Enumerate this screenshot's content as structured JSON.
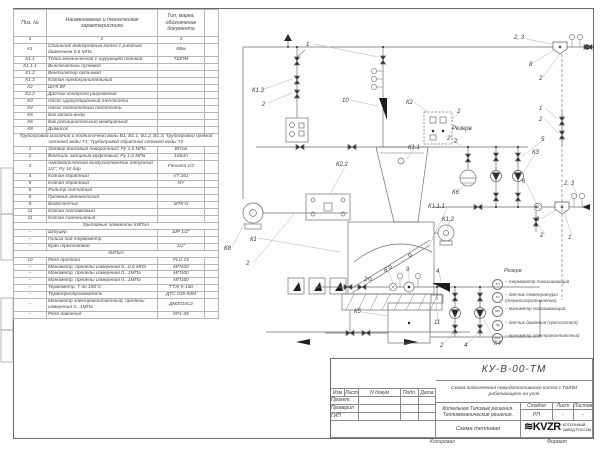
{
  "sheet": {
    "doc_code": "КУ-В-00-ТМ",
    "doc_title": "Схема подключения твердотопливного котла с ТШПМ работающего на угле",
    "object_line1": "Котельная.Типовые решения.",
    "object_line2": "Тепломеханические решения.",
    "stage_label": "Стадия",
    "stage_value": "РП",
    "sheet_label": "Лист",
    "sheet_value": "-",
    "sheets_label": "Листов",
    "sheets_value": "-",
    "drawing_name": "Схема тепловая",
    "logo_text": "KVZR",
    "logo_glyph": "≋",
    "company_line1": "КОТЕЛЬНЫЙ",
    "company_line2": "ЗАВОД РОССИИ",
    "footer_left": "Копировал",
    "footer_right": "Формат",
    "sign_cols": [
      "Изм",
      "Лист",
      "N докум",
      "Подп.",
      "Дата"
    ],
    "sign_rows": [
      "Проект.",
      "Проверил",
      "ГИП"
    ]
  },
  "spec_table": {
    "headers": [
      "Поз. №",
      "Наименование и техническая характеристика",
      "Тип, марка, обозначение документа"
    ],
    "col_numbers": [
      "1",
      "2",
      "3"
    ],
    "rows": [
      {
        "pos": "К1",
        "name": "Стальной водогрейный котел с рабочим давлением 0,6 МПа",
        "type": "КВм"
      },
      {
        "pos": "К1.1",
        "name": "Топка механическая с шурующей планкой",
        "type": "ТШПМ"
      },
      {
        "pos": "К1.1.1",
        "name": "Выключатель путевой",
        "type": ""
      },
      {
        "pos": "К1.2",
        "name": "Вентилятор дутьевой",
        "type": ""
      },
      {
        "pos": "К1.3",
        "name": "Клапан предохранительный",
        "type": ""
      },
      {
        "pos": "К2",
        "name": "ШУК ВТ",
        "type": ""
      },
      {
        "pos": "К2.2",
        "name": "Датчик контроля разряжения",
        "type": ""
      },
      {
        "pos": "К3",
        "name": "Насос циркуляционный теплосети",
        "type": ""
      },
      {
        "pos": "К4",
        "name": "Насос подпиточный теплосети",
        "type": ""
      },
      {
        "pos": "К5",
        "name": "Бак запаса воды",
        "type": ""
      },
      {
        "pos": "К6",
        "name": "Бак расширительный мембранный",
        "type": ""
      },
      {
        "pos": "К8",
        "name": "Дымосос",
        "type": ""
      },
      {
        "section": "Трубопровод исходной и подпиточной воды В1, В1.1, В1.2, В1.3; Трубопровод прямой сетевой воды Т1; Трубопровод обратной сетевой воды Т2"
      },
      {
        "pos": "1",
        "name": "Затвор дисковый поворотный; Ру 1,6 МПа",
        "type": "ВП1м"
      },
      {
        "pos": "2",
        "name": "Вентиль запорный муфтовый; Ру 1,6 МПа",
        "type": "15Б1п"
      },
      {
        "pos": "3",
        "name": "Автоматический воздухоотводчик латунный 1/2\"; Ру 10 бар",
        "type": "Flexvent 1/2"
      },
      {
        "pos": "4",
        "name": "Клапан обратный",
        "type": "V7.161"
      },
      {
        "pos": "5",
        "name": "Клапан обратный",
        "type": "NY"
      },
      {
        "pos": "6",
        "name": "Фильтр сетчатый",
        "type": ""
      },
      {
        "pos": "8",
        "name": "Грязевик абонентский",
        "type": ""
      },
      {
        "pos": "9",
        "name": "Водосчетчик",
        "type": "МТК-N"
      },
      {
        "pos": "11",
        "name": "Клапан поплавковый",
        "type": ""
      },
      {
        "pos": "11",
        "name": "Клапан соленоидный",
        "type": ""
      },
      {
        "section": "Закладные элементы КИПиА"
      },
      {
        "pos": "–",
        "name": "Штуцер",
        "type": "ШР 1/2\""
      },
      {
        "pos": "–",
        "name": "Гильза под термометр",
        "type": ""
      },
      {
        "pos": "–",
        "name": "Кран трехходовой",
        "type": "1/2\""
      },
      {
        "section": "КИПиА"
      },
      {
        "pos": "10",
        "name": "Реле протока",
        "type": "FLU 25"
      },
      {
        "pos": "–",
        "name": "Манометр, пределы измерения 0...0,6 МПа",
        "type": "МП100"
      },
      {
        "pos": "–",
        "name": "Манометр, пределы измерения 0...1МПа",
        "type": "МП100"
      },
      {
        "pos": "–",
        "name": "Манометр, пределы измерения 0...1МПа",
        "type": "МП160"
      },
      {
        "pos": "–",
        "name": "Термометр, Т до 150°С",
        "type": "ТТЖ 0-150"
      },
      {
        "pos": "–",
        "name": "Термопреобразователь",
        "type": "ДТС 035-50М"
      },
      {
        "pos": "–",
        "name": "Манометр электроконтактный, пределы измерения 0...1МПа",
        "type": "ДМ2010Сг"
      },
      {
        "pos": "–",
        "name": "Реле давления",
        "type": "КР1-35"
      }
    ]
  },
  "diagram": {
    "labels": [
      {
        "t": "1",
        "x": 306,
        "y": 46
      },
      {
        "t": "10",
        "x": 342,
        "y": 102
      },
      {
        "t": "К1.3",
        "x": 252,
        "y": 92
      },
      {
        "t": "2",
        "x": 262,
        "y": 106
      },
      {
        "t": "К2",
        "x": 406,
        "y": 104
      },
      {
        "t": "Резерв",
        "x": 452,
        "y": 130
      },
      {
        "t": "2",
        "x": 457,
        "y": 113
      },
      {
        "t": "2",
        "x": 454,
        "y": 143
      },
      {
        "t": "К1.1",
        "x": 408,
        "y": 149
      },
      {
        "t": "К2.2",
        "x": 336,
        "y": 166
      },
      {
        "t": "К1",
        "x": 250,
        "y": 241
      },
      {
        "t": "К8",
        "x": 224,
        "y": 250
      },
      {
        "t": "2",
        "x": 246,
        "y": 265
      },
      {
        "t": "К1.1.1",
        "x": 428,
        "y": 208
      },
      {
        "t": "К1.2",
        "x": 442,
        "y": 221
      },
      {
        "t": "2, 3",
        "x": 514,
        "y": 39
      },
      {
        "t": "8",
        "x": 529,
        "y": 66
      },
      {
        "t": "2",
        "x": 539,
        "y": 80
      },
      {
        "t": "1",
        "x": 539,
        "y": 110
      },
      {
        "t": "2",
        "x": 539,
        "y": 121
      },
      {
        "t": "2",
        "x": 447,
        "y": 140
      },
      {
        "t": "5",
        "x": 541,
        "y": 141
      },
      {
        "t": "К3",
        "x": 532,
        "y": 154
      },
      {
        "t": "6",
        "x": 522,
        "y": 183
      },
      {
        "t": "К6",
        "x": 452,
        "y": 194
      },
      {
        "t": "2, 3",
        "x": 564,
        "y": 185
      },
      {
        "t": "8",
        "x": 536,
        "y": 221
      },
      {
        "t": "2",
        "x": 540,
        "y": 237
      },
      {
        "t": "1",
        "x": 568,
        "y": 239
      },
      {
        "t": "2",
        "x": 364,
        "y": 281
      },
      {
        "t": "6",
        "x": 384,
        "y": 272
      },
      {
        "t": "9",
        "x": 406,
        "y": 271
      },
      {
        "t": "4",
        "x": 436,
        "y": 273
      },
      {
        "t": "К5",
        "x": 354,
        "y": 313
      },
      {
        "t": "11",
        "x": 434,
        "y": 324
      },
      {
        "t": "2",
        "x": 440,
        "y": 347
      },
      {
        "t": "4",
        "x": 464,
        "y": 347
      },
      {
        "t": "К4",
        "x": 494,
        "y": 345
      }
    ],
    "legend": {
      "title": "Резерв",
      "items": [
        {
          "code": "ТП",
          "text": "– термометр показывающий"
        },
        {
          "code": "ТС",
          "text": "– датчик температуры (термосопротивление)"
        },
        {
          "code": "МП",
          "text": "– манометр показывающий"
        },
        {
          "code": "РД",
          "text": "– датчик давления (прессостат)"
        },
        {
          "code": "МЭ",
          "text": "– манометр электроконтактный"
        }
      ]
    }
  }
}
